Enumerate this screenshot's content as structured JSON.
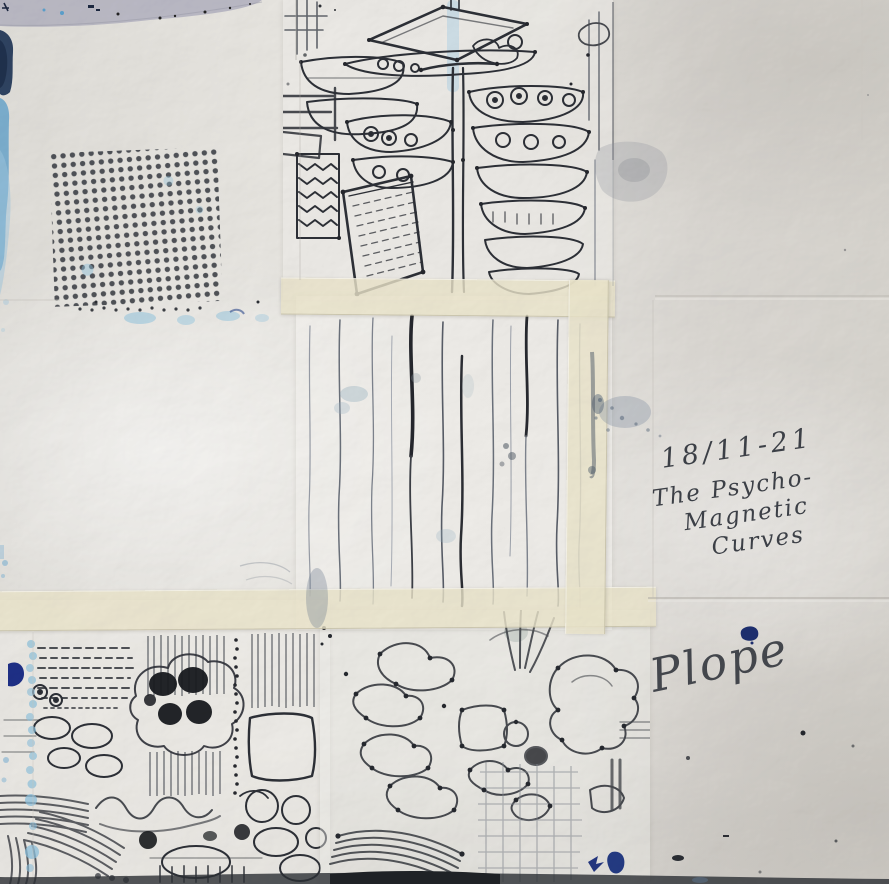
{
  "artwork": {
    "title": "The Psycho-Magnetic Curves",
    "inscription": {
      "date": "18/11-21",
      "title_line1": "The Psycho-",
      "title_line2": "Magnetic",
      "title_line3": "Curves"
    },
    "signature": "Plope",
    "colors": {
      "paper": "#dfddd8",
      "panel_paper": "#eeece8",
      "masking_tape": "#e9e3c9",
      "ink_black": "#26282e",
      "ink_faded": "#6c727c",
      "pen_ink": "#3c4047",
      "watercolor_light_blue": "#8cc0dc",
      "paint_navy": "#1e2f86",
      "paper_lavender": "#b5b4c1"
    },
    "elements": {
      "dot_stamp": "stamped grid of ink dots",
      "pillow_stack_drawing": "ink drawing of stacked cushions and box",
      "vertical_lines_panel": "taped monoprint of wavering vertical lines",
      "flower_cluster_drawing": "abstract ink print with dark blossom cluster",
      "cell_network_drawing": "looping line network with dotted nodes"
    }
  }
}
